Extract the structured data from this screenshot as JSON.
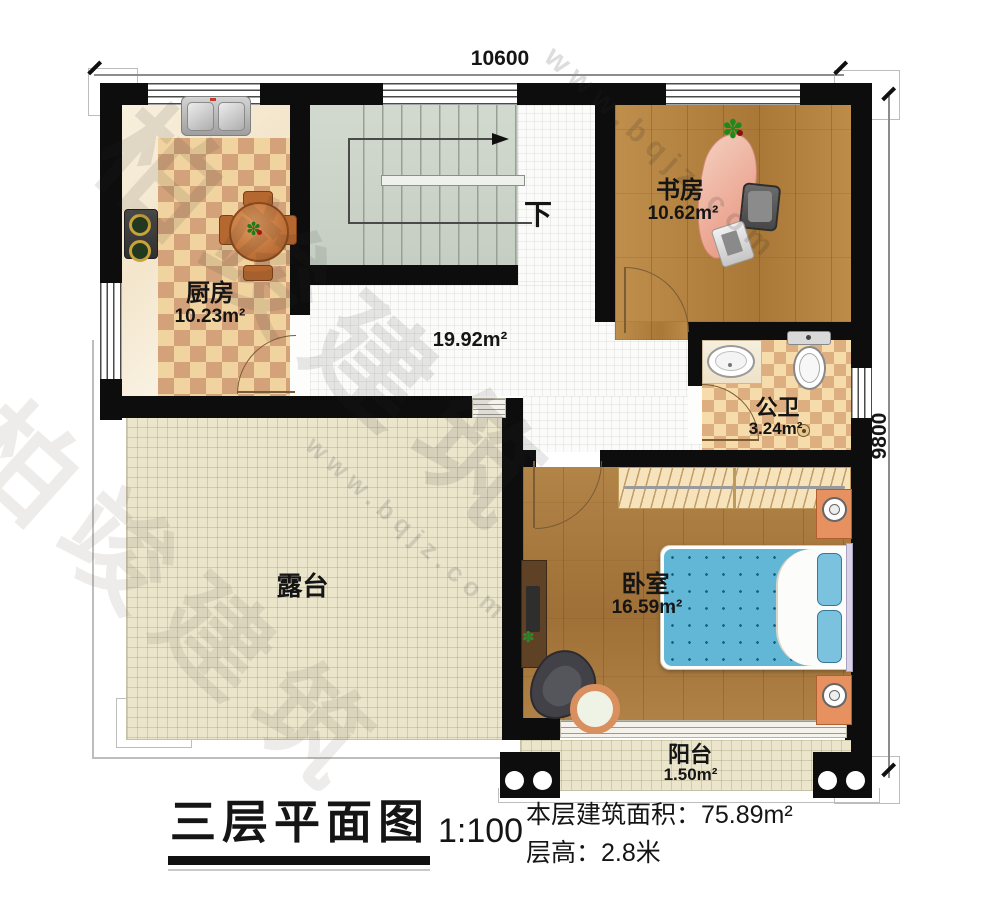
{
  "dimensions": {
    "top": "10600",
    "right": "9800"
  },
  "rooms": {
    "kitchen": {
      "name": "厨房",
      "area": "10.23m²"
    },
    "study": {
      "name": "书房",
      "area": "10.62m²"
    },
    "bathroom": {
      "name": "公卫",
      "area": "3.24m²"
    },
    "bedroom": {
      "name": "卧室",
      "area": "16.59m²"
    },
    "hallway": {
      "area": "19.92m²"
    },
    "terrace": {
      "name": "露台"
    },
    "balcony": {
      "name": "阳台",
      "area": "1.50m²"
    }
  },
  "stairs": {
    "direction_label": "下"
  },
  "title_block": {
    "title": "三层平面图",
    "scale": "1:100",
    "building_area": "本层建筑面积：75.89m²",
    "floor_height": "层高：2.8米"
  },
  "watermark": {
    "brand": "柏竣建筑",
    "site": "www.bqjz.com"
  },
  "colors": {
    "wall": "#0d0d0d",
    "wood": "#ae7d3e",
    "checker_tile": "#d3a27a",
    "terrace_tile": "#ebe5cc",
    "stairs": "#ccd3c8",
    "bed_blue": "#63b7d6"
  }
}
